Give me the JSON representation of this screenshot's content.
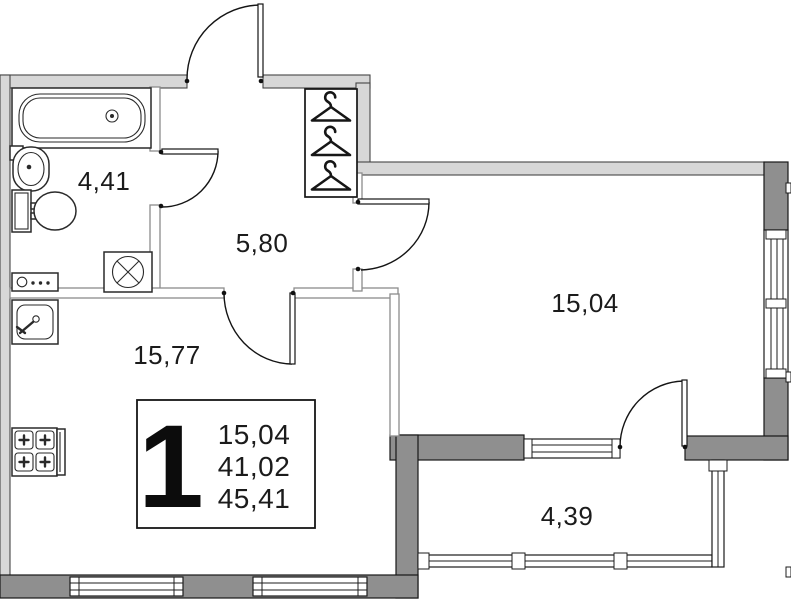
{
  "colors": {
    "wall_light": "#d7d7d7",
    "wall_dark": "#8f8f8f",
    "text": "#1b1b1b",
    "line": "#1a1a1a",
    "background": "#ffffff"
  },
  "rooms": {
    "bathroom": {
      "area": "4,41"
    },
    "hallway": {
      "area": "5,80"
    },
    "kitchen_living_room": {
      "area": "15,77"
    },
    "living_room": {
      "area": "15,04"
    },
    "balcony": {
      "area": "4,39"
    }
  },
  "legend": {
    "unit_number": "1",
    "areas": [
      "15,04",
      "41,02",
      "45,41"
    ]
  },
  "icons": {
    "bathtub": "bathtub-icon",
    "wash_basin": "wash-basin-icon",
    "toilet": "toilet-icon",
    "washing_machine": "washing-machine-icon",
    "electric_panel": "electric-panel-icon",
    "kitchen_sink": "kitchen-sink-icon",
    "stove": "stove-icon",
    "hangers": "hanger-icon"
  }
}
